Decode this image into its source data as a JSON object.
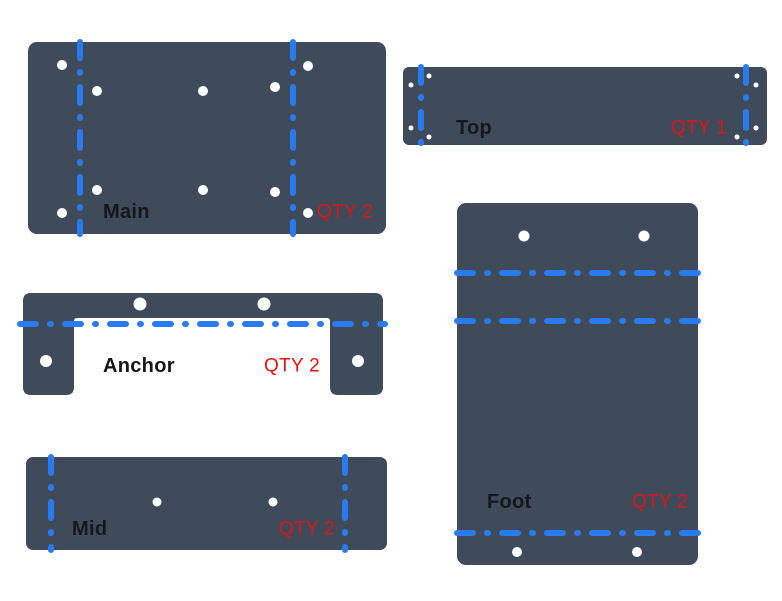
{
  "canvas": {
    "width": 782,
    "height": 601,
    "background": "#ffffff"
  },
  "colors": {
    "plate": "#3f4b5a",
    "fold_line": "#2a7af0",
    "hole": "#ffffff",
    "label": "#14181d",
    "qty": "#e01414"
  },
  "fold_style": {
    "stroke_width": 6,
    "dash_array": "16 14 1 14"
  },
  "parts": [
    {
      "id": "main",
      "label": "Main",
      "qty_label": "QTY 2",
      "shape": {
        "type": "rect",
        "x": 28,
        "y": 42,
        "width": 358,
        "height": 192,
        "radius": 9
      },
      "fold_lines": [
        {
          "orientation": "vertical",
          "pos": 80,
          "from": 42,
          "to": 234
        },
        {
          "orientation": "vertical",
          "pos": 293,
          "from": 42,
          "to": 234
        }
      ],
      "holes": [
        {
          "x": 62,
          "y": 65,
          "r": 5
        },
        {
          "x": 97,
          "y": 91,
          "r": 5
        },
        {
          "x": 203,
          "y": 91,
          "r": 5
        },
        {
          "x": 275,
          "y": 87,
          "r": 5
        },
        {
          "x": 308,
          "y": 66,
          "r": 5
        },
        {
          "x": 97,
          "y": 190,
          "r": 5
        },
        {
          "x": 203,
          "y": 190,
          "r": 5
        },
        {
          "x": 275,
          "y": 192,
          "r": 5
        },
        {
          "x": 62,
          "y": 213,
          "r": 5
        },
        {
          "x": 308,
          "y": 213,
          "r": 5
        }
      ],
      "label_pos": {
        "x": 103,
        "y": 212
      },
      "qty_pos": {
        "x": 373,
        "y": 212
      }
    },
    {
      "id": "top",
      "label": "Top",
      "qty_label": "QTY 1",
      "shape": {
        "type": "rect",
        "x": 403,
        "y": 67,
        "width": 364,
        "height": 78,
        "radius": 6
      },
      "fold_lines": [
        {
          "orientation": "vertical",
          "pos": 421,
          "from": 67,
          "to": 145
        },
        {
          "orientation": "vertical",
          "pos": 746,
          "from": 67,
          "to": 145
        }
      ],
      "holes": [
        {
          "x": 429,
          "y": 76,
          "r": 2.5
        },
        {
          "x": 411,
          "y": 85,
          "r": 2.5
        },
        {
          "x": 411,
          "y": 128,
          "r": 2.5
        },
        {
          "x": 429,
          "y": 137,
          "r": 2.5
        },
        {
          "x": 737,
          "y": 76,
          "r": 2.5
        },
        {
          "x": 756,
          "y": 85,
          "r": 2.5
        },
        {
          "x": 756,
          "y": 128,
          "r": 2.5
        },
        {
          "x": 737,
          "y": 137,
          "r": 2.5
        }
      ],
      "label_pos": {
        "x": 456,
        "y": 128
      },
      "qty_pos": {
        "x": 727,
        "y": 128
      }
    },
    {
      "id": "anchor",
      "label": "Anchor",
      "qty_label": "QTY 2",
      "shape": {
        "type": "bracket",
        "x": 23,
        "y": 293,
        "width": 360,
        "height": 102,
        "bar_height": 25,
        "left_leg_width": 51,
        "right_leg_width": 53,
        "corner_radius": 8,
        "inner_radius": 3
      },
      "fold_lines": [
        {
          "orientation": "horizontal",
          "pos": 324,
          "from": 20,
          "to": 385
        }
      ],
      "holes": [
        {
          "x": 140,
          "y": 304,
          "r": 6.5
        },
        {
          "x": 264,
          "y": 304,
          "r": 6.5
        },
        {
          "x": 46,
          "y": 361,
          "r": 6
        },
        {
          "x": 358,
          "y": 361,
          "r": 6
        }
      ],
      "label_pos": {
        "x": 103,
        "y": 366
      },
      "qty_pos": {
        "x": 320,
        "y": 366
      }
    },
    {
      "id": "mid",
      "label": "Mid",
      "qty_label": "QTY 2",
      "shape": {
        "type": "rect",
        "x": 26,
        "y": 457,
        "width": 361,
        "height": 93,
        "radius": 7
      },
      "fold_lines": [
        {
          "orientation": "vertical",
          "pos": 51,
          "from": 457,
          "to": 550
        },
        {
          "orientation": "vertical",
          "pos": 345,
          "from": 457,
          "to": 550
        }
      ],
      "holes": [
        {
          "x": 157,
          "y": 502,
          "r": 4.5
        },
        {
          "x": 273,
          "y": 502,
          "r": 4.5
        }
      ],
      "label_pos": {
        "x": 72,
        "y": 529
      },
      "qty_pos": {
        "x": 335,
        "y": 529
      }
    },
    {
      "id": "foot",
      "label": "Foot",
      "qty_label": "QTY 2",
      "shape": {
        "type": "rect",
        "x": 457,
        "y": 203,
        "width": 241,
        "height": 362,
        "radius": 9
      },
      "fold_lines": [
        {
          "orientation": "horizontal",
          "pos": 273,
          "from": 457,
          "to": 698
        },
        {
          "orientation": "horizontal",
          "pos": 321,
          "from": 457,
          "to": 698
        },
        {
          "orientation": "horizontal",
          "pos": 533,
          "from": 457,
          "to": 698
        }
      ],
      "holes": [
        {
          "x": 524,
          "y": 236,
          "r": 5.5
        },
        {
          "x": 644,
          "y": 236,
          "r": 5.5
        },
        {
          "x": 517,
          "y": 552,
          "r": 5
        },
        {
          "x": 637,
          "y": 552,
          "r": 5
        }
      ],
      "label_pos": {
        "x": 487,
        "y": 502
      },
      "qty_pos": {
        "x": 688,
        "y": 502
      }
    }
  ]
}
